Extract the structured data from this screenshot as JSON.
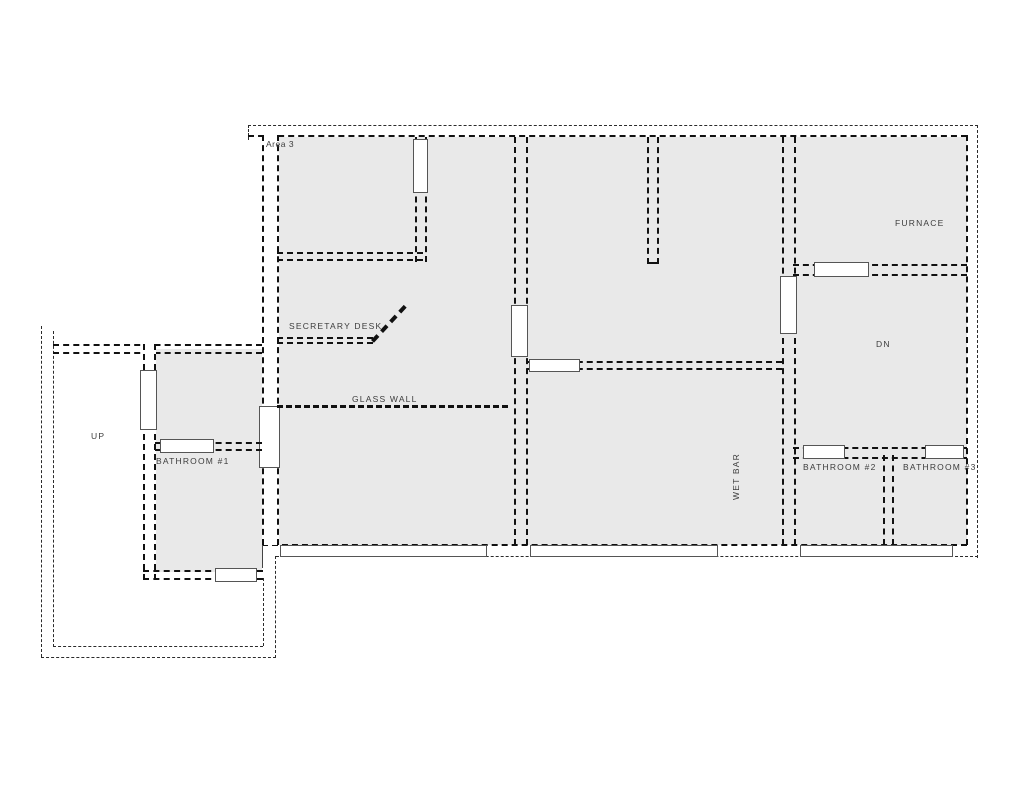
{
  "labels": {
    "area": "Area 3",
    "secretary_desk": "SECRETARY DESK",
    "glass_wall": "GLASS WALL",
    "up": "UP",
    "bathroom1": "BATHROOM #1",
    "wet_bar": "WET BAR",
    "dn": "DN",
    "furnace": "FURNACE",
    "bathroom2": "BATHROOM #2",
    "bathroom3": "BATHROOM #3"
  },
  "colors": {
    "room_fill": "#e9e9e9",
    "line": "#111111",
    "background": "#ffffff"
  }
}
